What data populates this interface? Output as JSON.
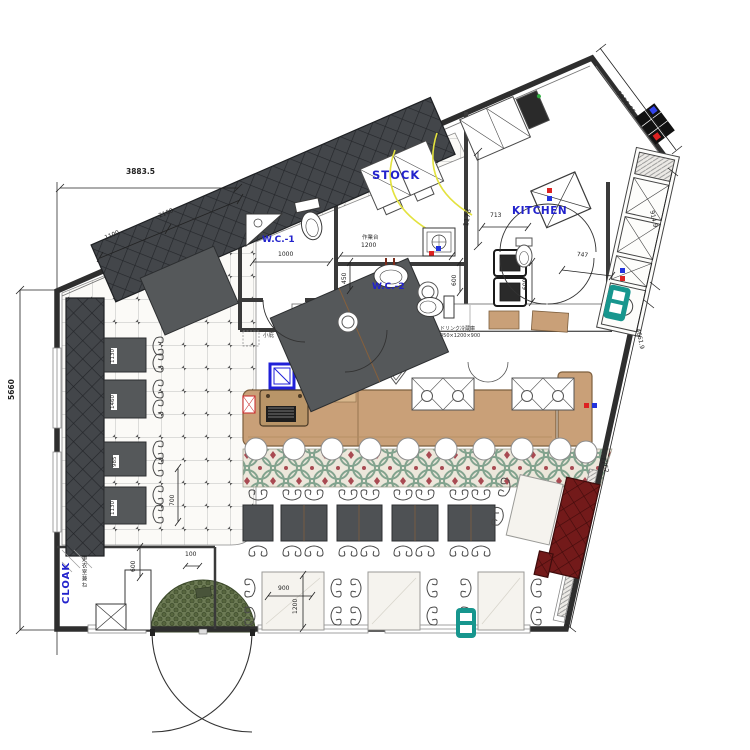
{
  "rooms": {
    "wc1": "W.C.-1",
    "stock": "STOCK",
    "wc2": "W.C.-2",
    "kitchen": "KITCHEN",
    "cloak": "CLOAK",
    "cloak_note": "更衣室兼ね"
  },
  "annotations": {
    "workbench": "作業台",
    "canopy": "小庇",
    "drink_fridge": "ドリンク冷蔵庫",
    "drink_fridge_size": "450×1200×900"
  },
  "dims": {
    "top_width": "3883.5",
    "top_seg1": "1100",
    "top_seg2": "2100",
    "left_height": "5660",
    "wc1_width": "1000",
    "workbench_width": "1200",
    "counter_depth": "450",
    "basin_depth": "600",
    "stock_depth": "1178",
    "kitchen_width": "713",
    "kitchen_pass": "747",
    "kitchen_depth": "600",
    "top_right_wall": "5956.05",
    "right_seg1": "914.9",
    "right_seg2": "4661.9",
    "right_seg3": "7762",
    "table1": "1130",
    "table2": "1460",
    "table3": "985",
    "table4": "1130",
    "table_gap": "700",
    "cloak_depth": "600",
    "entry_offset": "100",
    "bottom_table_width": "900",
    "bottom_table_depth": "1200"
  },
  "colors": {
    "label_blue": "#2222cc",
    "counter_tan": "#c9a078",
    "bench_dark": "#43464a",
    "bench_red": "#731a1a",
    "outlet_teal": "#17968e",
    "mat_green": "#6d7b55",
    "ornate_green": "#82a38e",
    "ornate_red": "#a84a52",
    "door_arc_yellow": "#e3e23e"
  }
}
